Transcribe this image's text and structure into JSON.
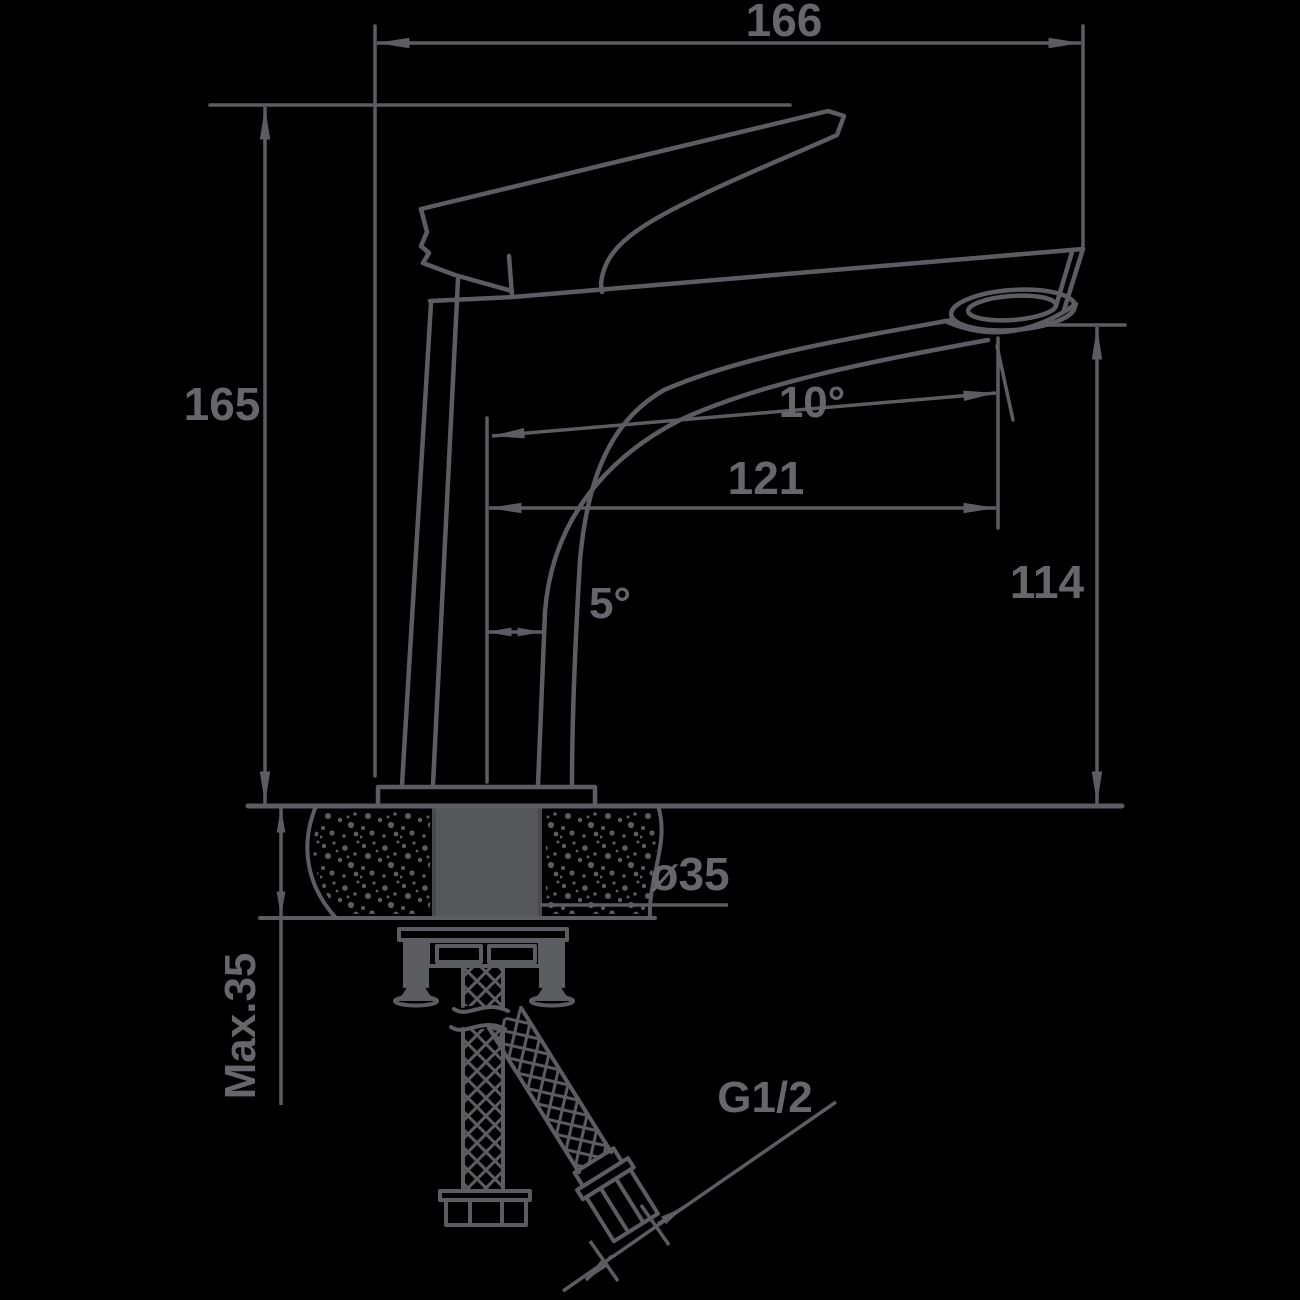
{
  "drawing": {
    "title": "basin-mixer-installation-dimensional-drawing",
    "background_color": "#000000",
    "line_color": "#5c5d60",
    "text_color": "#66676a",
    "dimensions": {
      "overall_length": "166",
      "overall_height": "165",
      "spout_reach": "121",
      "outlet_height": "114",
      "spout_angle": "10°",
      "body_tilt_angle": "5°",
      "mounting_hole_diameter": "ø35",
      "max_deck_thickness": "Max.35",
      "hose_thread_size": "G1/2"
    }
  }
}
